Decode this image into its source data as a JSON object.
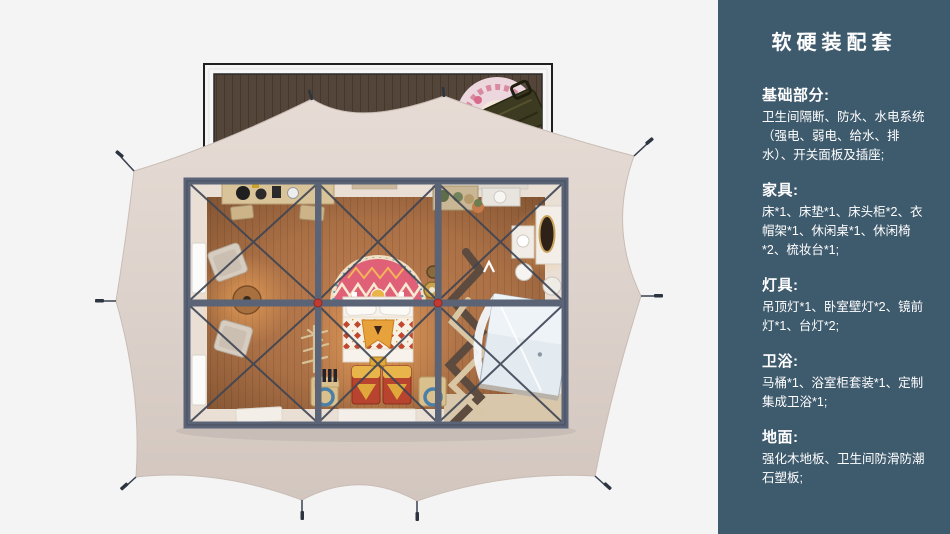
{
  "panel": {
    "title": "软硬装配套",
    "background": "#3e5a6d",
    "text_color": "#ffffff",
    "sections": [
      {
        "heading": "基础部分:",
        "body": "卫生间隔断、防水、水电系统（强电、弱电、给水、排水）、开关面板及插座;"
      },
      {
        "heading": "家具:",
        "body": "床*1、床垫*1、床头柜*2、衣帽架*1、休闲桌*1、休闲椅*2、梳妆台*1;"
      },
      {
        "heading": "灯具:",
        "body": "吊顶灯*1、卧室壁灯*2、镜前灯*1、台灯*2;"
      },
      {
        "heading": "卫浴:",
        "body": "马桶*1、浴室柜套装*1、定制集成卫浴*1;"
      },
      {
        "heading": "地面:",
        "body": "强化木地板、卫生间防滑防潮石塑板;"
      }
    ]
  },
  "illustration": {
    "type": "top-down 3d floor plan of a framed glamping tent",
    "visible_objects": [
      "wood-deck",
      "deck-round-rug",
      "deck-bench",
      "tent-canvas",
      "guy-line-stakes",
      "steel-frame",
      "cross-bracing",
      "red-frame-joints",
      "wood-floor",
      "console-table",
      "armchairs",
      "round-tea-table",
      "windows",
      "bed",
      "arch-headboard-rug",
      "patterned-blanket",
      "storage-chests",
      "bedside-stools",
      "branch-decor",
      "bottle-rack",
      "clothes-rack",
      "vanity-mirror",
      "vanity-stool",
      "toilet",
      "wash-cabinet",
      "plant-shelf",
      "integrated-shower-unit",
      "floor-mats"
    ],
    "colors": {
      "page_bg": "#f4f4f4",
      "canvas": "#ddd2cb",
      "deck_wood": "#53453a",
      "frame_steel": "#5b6477",
      "floor_wood": "#a96f45",
      "joint_red": "#c23a31",
      "rug_pink": "#e06077",
      "blanket_red": "#c1472f",
      "glass_blue": "#e3eaf0"
    }
  }
}
